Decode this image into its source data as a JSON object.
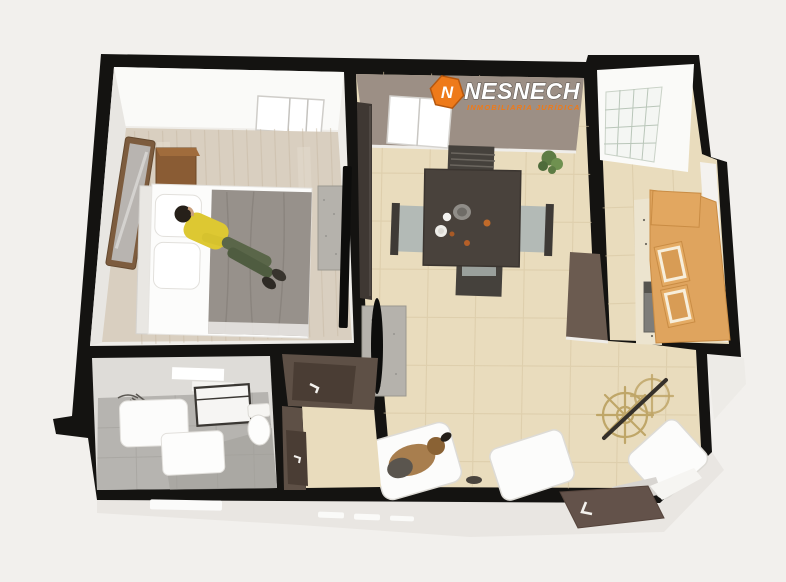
{
  "watermark": {
    "brand": "NESNECH",
    "tagline": "INMOBILIARIA JURÍDICA",
    "icon": "hexagon-n-icon",
    "icon_letter": "N",
    "accent_color": "#ee7a1a"
  },
  "palette": {
    "bg": "#f2f0ed",
    "wall": "#141311",
    "slab": "#e9e6e2",
    "tile_floor": "#e9dcbd",
    "tile_line": "#d8c6a2",
    "wood_floor": "#d9cfc0",
    "bath_floor": "#b6b4b0",
    "wall_face_white": "#fafaf8",
    "wall_face_taupe": "#9c8f85",
    "brown_wall": "#5e5046",
    "door_brown": "#4a3d34",
    "cabinet_wood": "#dfa45e",
    "furniture_wood": "#8a5c34",
    "blanket_gray": "#97918b",
    "white_furniture": "#fcfcfb",
    "table_dark": "#49423c",
    "chair_gray": "#b3bab6",
    "tv_black": "#0d0d0c",
    "stand_gray": "#b5b2ac",
    "shirt_yellow": "#ddc832",
    "pants_green": "#5a6649",
    "dog_brown": "#a87e4e",
    "wheel_gold": "#bfa668",
    "plant_green": "#5d7c44",
    "accent_orange": "#ee7a1a"
  },
  "floorplan": {
    "type": "3d-floor-plan-top-view",
    "rooms": [
      {
        "name": "bedroom",
        "items": [
          "double-bed",
          "person-lying",
          "pillows",
          "nightstand-top",
          "nightstand-bottom",
          "leaning-mirror",
          "dresser",
          "wall-tv",
          "window",
          "wood-floor"
        ]
      },
      {
        "name": "dining-room",
        "items": [
          "dining-table",
          "chair-north",
          "chair-south",
          "chair-west",
          "chair-east",
          "tableware",
          "potted-plant",
          "dark-tall-cabinet",
          "window",
          "tile-floor"
        ]
      },
      {
        "name": "kitchen",
        "items": [
          "cabinet-run",
          "upper-cabinet",
          "upper-cabinet",
          "stove",
          "counter",
          "grid-window",
          "tile-floor"
        ]
      },
      {
        "name": "bathroom",
        "items": [
          "shower-sketch",
          "vanity",
          "vanity-cabinet",
          "towel-rack",
          "toilet",
          "gray-tile-floor"
        ]
      },
      {
        "name": "hallway",
        "items": [
          "open-door",
          "open-door"
        ]
      },
      {
        "name": "living-area",
        "items": [
          "armchair-with-dog",
          "armchair",
          "corner-armchair",
          "tv-on-stand",
          "ship-wheel-decor"
        ]
      },
      {
        "name": "exterior",
        "items": [
          "entry-door-open",
          "brown-doormat",
          "white-doormat",
          "shoes-pairs",
          "concrete-slab"
        ]
      }
    ]
  }
}
